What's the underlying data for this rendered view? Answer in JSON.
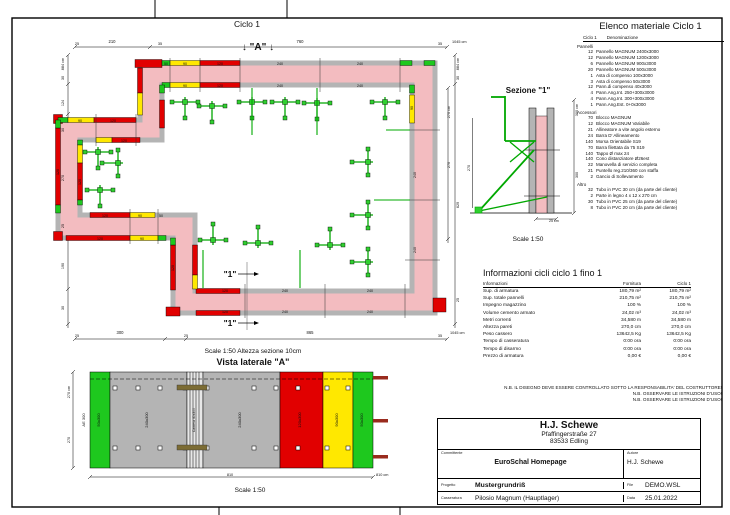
{
  "plan": {
    "title": "Ciclo 1",
    "marker_a": "↓ \"A\" ↓",
    "marker_1": "\"1\"",
    "scale_note": "Scale 1:50   Altezza sezione 10cm"
  },
  "sezione": {
    "title": "Sezione \"1\"",
    "scale": "Scale 1:50"
  },
  "vista": {
    "title": "Vista laterale \"A\"",
    "scale": "Scale 1:50"
  },
  "materials": {
    "title": "Elenco materiale  Ciclo 1",
    "col1": "Ciclo 1",
    "col2": "Denominazione",
    "sections": [
      {
        "label": "Pannelli",
        "items": [
          {
            "q": "12",
            "n": "Pannello MAGNUM 2400x3000"
          },
          {
            "q": "12",
            "n": "Pannello MAGNUM 1200x3000"
          },
          {
            "q": "6",
            "n": "Pannello MAGNUM 900x3000"
          },
          {
            "q": "20",
            "n": "Pannello MAGNUM 500x3000"
          },
          {
            "q": "1",
            "n": "Asta di compenso 100x3000"
          },
          {
            "q": "3",
            "n": "Asta di compenso 50x3000"
          },
          {
            "q": "12",
            "n": "Pann.di compenso 40x3000"
          },
          {
            "q": "4",
            "n": "Pann.Ang.Int. 250+300x3000"
          },
          {
            "q": "4",
            "n": "Pann.Ang.Int. 300+300x3000"
          },
          {
            "q": "1",
            "n": "Pann.Ang.Est. 0+0x3000"
          }
        ]
      },
      {
        "label": "Accessori",
        "items": [
          {
            "q": "70",
            "n": "Blocco MAGNUM"
          },
          {
            "q": "12",
            "n": "Blocco MAGNUM Variabile"
          },
          {
            "q": "21",
            "n": "Allineatore a vite angolo esterno"
          },
          {
            "q": "24",
            "n": "Barra D' Allineamento"
          },
          {
            "q": "140",
            "n": "Morsa Orientabile S19"
          },
          {
            "q": "70",
            "n": "Barra filettata da 75 S19"
          },
          {
            "q": "140",
            "n": "Tappo Ø max 24"
          },
          {
            "q": "140",
            "n": "Cono distanziatore Ø26est"
          },
          {
            "q": "22",
            "n": "Manovella di servizio completa"
          },
          {
            "q": "21",
            "n": "Puntello reg.210/360 con staffa"
          },
          {
            "q": "2",
            "n": "Gancio di Sollevamento"
          }
        ]
      },
      {
        "label": "Altro",
        "items": [
          {
            "q": "32",
            "n": "Tubo in PVC 30 cm (da parte del cliente)"
          },
          {
            "q": "2",
            "n": "Parte in legno 4 x 12 x 270 cm"
          },
          {
            "q": "30",
            "n": "Tubo in PVC 25 cm (da parte del cliente)"
          },
          {
            "q": "8",
            "n": "Tubo in PVC 20 cm (da parte del cliente)"
          }
        ]
      }
    ]
  },
  "info": {
    "title": "Informazioni cicli  ciclo 1 fino 1",
    "headers": {
      "label": "Informazioni",
      "fornitura": "Fornitura",
      "ciclo": "Ciclo 1"
    },
    "rows": [
      {
        "label": "Sup. di armatura",
        "f": "180,79 m²",
        "c": "180,79 m²"
      },
      {
        "label": "Sup. totale pannelli",
        "f": "210,75 m²",
        "c": "210,75 m²"
      },
      {
        "label": "Impegno magazzino",
        "f": "100 %",
        "c": "100 %"
      },
      {
        "label": "Volume cemento armato",
        "f": "24,02 m³",
        "c": "24,02 m³"
      },
      {
        "label": "Metri correnti",
        "f": "34,580 m",
        "c": "34,580 m"
      },
      {
        "label": "Altezza pareti",
        "f": "270,0 cm",
        "c": "270,0 cm"
      },
      {
        "label": "Peso cassero",
        "f": "13642,5 Kg",
        "c": "13642,5 Kg"
      },
      {
        "label": "Tempo di casseratura",
        "f": "0:00 ora",
        "c": "0:00 ora"
      },
      {
        "label": "Tempo di disarmo",
        "f": "0:00 ora",
        "c": "0:00 ora"
      },
      {
        "label": "Prezzo di armatura",
        "f": "0,00 €",
        "c": "0,00 €"
      }
    ]
  },
  "notes": [
    "N.B. IL DISEGNO DEVE ESSERE CONTROLLATO SOTTO LA RESPONSABILITA' DEL COSTRUTTORE!",
    "N.B. OSSERVARE LE ISTRUZIONI D'USO!",
    "N.B. OSSERVARE LE ISTRUZIONI D'USO!"
  ],
  "title_block": {
    "company": "H.J. Schewe",
    "address1": "Pfaffingerstraße 27",
    "address2": "83533 Edling",
    "committente_label": "Committente",
    "committente": "EuroSchal Homepage",
    "autore_label": "Autore",
    "autore": "H.J. Schewe",
    "progetto_label": "Progetto",
    "progetto": "Mustergrundriß",
    "file_label": "File",
    "file": "DEMO.WSL",
    "casseratura_label": "Casseratura",
    "casseratura": "Pilosio Magnum (Hauptlager)",
    "data_label": "Data",
    "data": "25.01.2022"
  },
  "colors": {
    "concrete_pink": "#f3bcc0",
    "panel_gray": "#b4b4b4",
    "panel_red": "#e10000",
    "panel_yellow": "#ffe800",
    "panel_green": "#1ec81e",
    "prop_green": "#00a800",
    "bar_brown": "#992b1e"
  },
  "drawing_labels": [
    {
      "t": "25",
      "x": 77,
      "y": 45,
      "s": 3.8
    },
    {
      "t": "210",
      "x": 112,
      "y": 43,
      "s": 4.2
    },
    {
      "t": "35",
      "x": 160,
      "y": 45,
      "s": 3.8
    },
    {
      "t": "760",
      "x": 300,
      "y": 43,
      "s": 4.2
    },
    {
      "t": "35",
      "x": 440,
      "y": 45,
      "s": 3.8
    },
    {
      "t": "1045 cm",
      "x": 452,
      "y": 43,
      "s": 3.8,
      "a": "start"
    },
    {
      "t": "884 cm",
      "x": 64,
      "y": 64,
      "r": -90,
      "s": 3.8
    },
    {
      "t": "30",
      "x": 64,
      "y": 78,
      "r": -90,
      "s": 3.8
    },
    {
      "t": "124",
      "x": 64,
      "y": 103,
      "r": -90,
      "s": 3.8
    },
    {
      "t": "30",
      "x": 64,
      "y": 130,
      "r": -90,
      "s": 3.8
    },
    {
      "t": "270",
      "x": 64,
      "y": 178,
      "r": -90,
      "s": 3.8
    },
    {
      "t": "25",
      "x": 64,
      "y": 226,
      "r": -90,
      "s": 3.8
    },
    {
      "t": "190",
      "x": 64,
      "y": 266,
      "r": -90,
      "s": 3.8
    },
    {
      "t": "30",
      "x": 64,
      "y": 308,
      "r": -90,
      "s": 3.8
    },
    {
      "t": "884 cm",
      "x": 459,
      "y": 64,
      "r": -90,
      "s": 3.8
    },
    {
      "t": "30",
      "x": 459,
      "y": 78,
      "r": -90,
      "s": 3.8
    },
    {
      "t": "270 cm",
      "x": 450,
      "y": 112,
      "r": -90,
      "s": 3.8
    },
    {
      "t": "270",
      "x": 450,
      "y": 165,
      "r": -90,
      "s": 3.8
    },
    {
      "t": "629",
      "x": 459,
      "y": 205,
      "r": -90,
      "s": 3.8
    },
    {
      "t": "25",
      "x": 459,
      "y": 300,
      "r": -90,
      "s": 3.8
    },
    {
      "t": "25",
      "x": 77,
      "y": 337,
      "s": 3.8
    },
    {
      "t": "300",
      "x": 120,
      "y": 334,
      "s": 4.2
    },
    {
      "t": "25",
      "x": 186,
      "y": 337,
      "s": 3.8
    },
    {
      "t": "865",
      "x": 310,
      "y": 334,
      "s": 4.2
    },
    {
      "t": "35",
      "x": 440,
      "y": 337,
      "s": 3.8
    },
    {
      "t": "1045 cm",
      "x": 450,
      "y": 334,
      "s": 3.8,
      "a": "start"
    },
    {
      "t": "50",
      "x": 166,
      "y": 65,
      "s": 3.6
    },
    {
      "t": "90",
      "x": 185,
      "y": 65,
      "s": 3.6
    },
    {
      "t": "120",
      "x": 220,
      "y": 65,
      "s": 3.6
    },
    {
      "t": "240",
      "x": 280,
      "y": 65,
      "s": 3.6
    },
    {
      "t": "240",
      "x": 360,
      "y": 65,
      "s": 3.6
    },
    {
      "t": "90",
      "x": 185,
      "y": 87,
      "s": 3.6
    },
    {
      "t": "120",
      "x": 220,
      "y": 87,
      "s": 3.6
    },
    {
      "t": "240",
      "x": 280,
      "y": 87,
      "s": 3.6
    },
    {
      "t": "240",
      "x": 360,
      "y": 87,
      "s": 3.6
    },
    {
      "t": "90",
      "x": 413,
      "y": 108,
      "r": -90,
      "s": 3.6
    },
    {
      "t": "240",
      "x": 416,
      "y": 175,
      "r": -90,
      "s": 3.6
    },
    {
      "t": "240",
      "x": 416,
      "y": 250,
      "r": -90,
      "s": 3.6
    },
    {
      "t": "120",
      "x": 225,
      "y": 292,
      "s": 3.6
    },
    {
      "t": "240",
      "x": 285,
      "y": 292,
      "s": 3.6
    },
    {
      "t": "240",
      "x": 370,
      "y": 292,
      "s": 3.6
    },
    {
      "t": "120",
      "x": 225,
      "y": 313,
      "s": 3.6
    },
    {
      "t": "240",
      "x": 285,
      "y": 313,
      "s": 3.6
    },
    {
      "t": "240",
      "x": 370,
      "y": 313,
      "s": 3.6
    },
    {
      "t": "90",
      "x": 80,
      "y": 122,
      "s": 3.6
    },
    {
      "t": "120",
      "x": 113,
      "y": 122,
      "s": 3.6
    },
    {
      "t": "120",
      "x": 124,
      "y": 142,
      "s": 3.6
    },
    {
      "t": "120",
      "x": 59,
      "y": 172,
      "r": -90,
      "s": 3.6
    },
    {
      "t": "120",
      "x": 81,
      "y": 182,
      "r": -90,
      "s": 3.6
    },
    {
      "t": "120",
      "x": 100,
      "y": 240,
      "s": 3.6
    },
    {
      "t": "90",
      "x": 142,
      "y": 240,
      "s": 3.6
    },
    {
      "t": "120",
      "x": 105,
      "y": 217,
      "s": 3.6
    },
    {
      "t": "90",
      "x": 140,
      "y": 217,
      "s": 3.6
    },
    {
      "t": "50",
      "x": 161,
      "y": 217,
      "s": 3.6
    },
    {
      "t": "120",
      "x": 174,
      "y": 268,
      "r": -90,
      "s": 3.6
    },
    {
      "t": "300 cm",
      "x": 578,
      "y": 110,
      "r": -90,
      "s": 3.8
    },
    {
      "t": "300",
      "x": 578,
      "y": 175,
      "r": -90,
      "s": 3.8
    },
    {
      "t": "270",
      "x": 470,
      "y": 168,
      "r": -90,
      "s": 3.8
    },
    {
      "t": "25 cm",
      "x": 549,
      "y": 222,
      "s": 3.6,
      "a": "start"
    },
    {
      "t": "AE 300",
      "x": 85,
      "y": 420,
      "r": -90,
      "s": 4
    },
    {
      "t": "50x300",
      "x": 100,
      "y": 420,
      "r": -90,
      "s": 4
    },
    {
      "t": "240x300",
      "x": 148,
      "y": 420,
      "r": -90,
      "s": 4
    },
    {
      "t": "Camera 40x300",
      "x": 195,
      "y": 420,
      "r": -90,
      "s": 3.4
    },
    {
      "t": "240x300",
      "x": 241,
      "y": 420,
      "r": -90,
      "s": 4
    },
    {
      "t": "120x300",
      "x": 301,
      "y": 420,
      "r": -90,
      "s": 4
    },
    {
      "t": "90x300",
      "x": 338,
      "y": 420,
      "r": -90,
      "s": 4
    },
    {
      "t": "50x300",
      "x": 363,
      "y": 420,
      "r": -90,
      "s": 4
    },
    {
      "t": "270 cm",
      "x": 70,
      "y": 392,
      "r": -90,
      "s": 3.8
    },
    {
      "t": "270",
      "x": 70,
      "y": 440,
      "r": -90,
      "s": 3.8
    },
    {
      "t": "810",
      "x": 230,
      "y": 476,
      "s": 3.8
    },
    {
      "t": "810 cm",
      "x": 376,
      "y": 476,
      "s": 3.8,
      "a": "start"
    }
  ]
}
